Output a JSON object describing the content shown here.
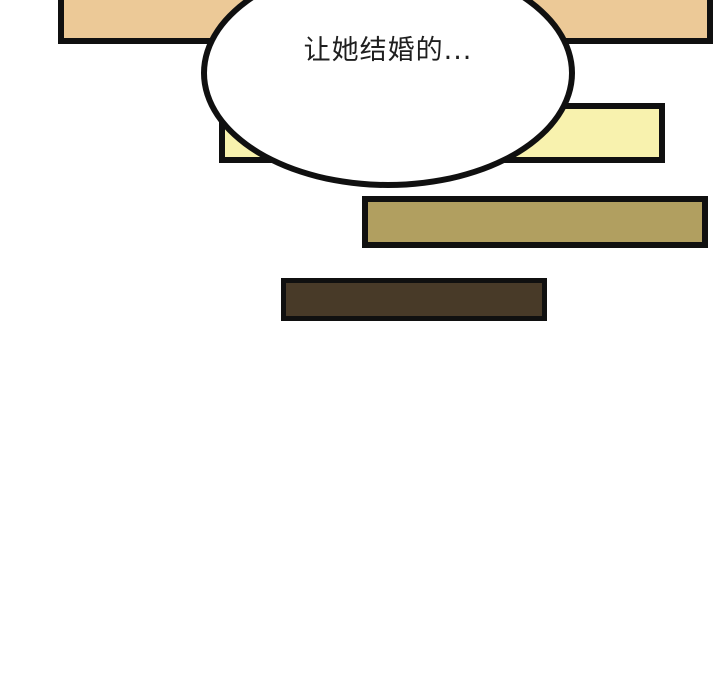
{
  "panel": {
    "type": "comic-panel",
    "speech_bubble": {
      "text": "让她结婚的..."
    },
    "colors": {
      "background": "#ffffff",
      "outline": "#101010",
      "tan_bar": "#ecc997",
      "yellow_bar": "#f8f2ae",
      "khaki_bar": "#b19f60",
      "brown_bar": "#483a28",
      "bubble_fill": "#ffffff",
      "text": "#1f1f1f"
    }
  }
}
